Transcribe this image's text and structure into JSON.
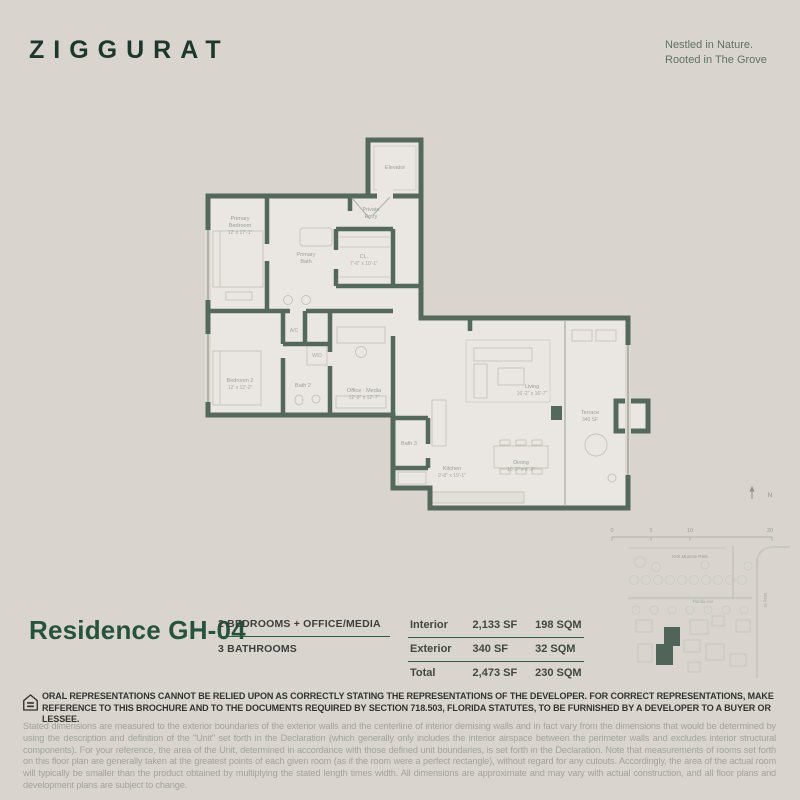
{
  "colors": {
    "background": "#d9d4ce",
    "wall_green": "#55685c",
    "brand_green": "#1c382c",
    "title_green": "#26523e",
    "rule_green": "#2f5c46",
    "floor_fill": "#eae7e2"
  },
  "icons": {
    "equal_housing": "equal-housing-logo",
    "north_arrow": "north-arrow-icon"
  },
  "header": {
    "logo": "ZIGGURAT",
    "tagline_line1": "Nestled in Nature.",
    "tagline_line2": "Rooted in The Grove"
  },
  "floorplan": {
    "elevator": "Elevator",
    "private_entry_1": "Private",
    "private_entry_2": "Entry",
    "primary_bedroom_1": "Primary",
    "primary_bedroom_2": "Bedroom",
    "primary_bedroom_dims": "12' x 17'-1\"",
    "primary_bath_1": "Primary",
    "primary_bath_2": "Bath",
    "closet_name": "CL.",
    "closet_dims": "7'-6\" x 10'-1\"",
    "ac": "A/C",
    "wd": "W/D",
    "bath2": "Bath 2",
    "bedroom2_name": "Bedroom 2",
    "bedroom2_dims": "12' x 12'-2\"",
    "office_name": "Office · Media",
    "office_dims": "12'-9\" x 12'-7\"",
    "bath3": "Bath 3",
    "kitchen_name": "Kitchen",
    "kitchen_dims": "9'-8\" x 19'-1\"",
    "dining_name": "Dining",
    "dining_dims": "10'-2\" x 8'-9\"",
    "living_name": "Living",
    "living_dims": "16'-2\" x 16'-7\"",
    "terrace_name": "Terrace",
    "terrace_dims": "340 SF"
  },
  "sitemap": {
    "north": "N",
    "scale": [
      "0",
      "5",
      "10",
      "20"
    ],
    "park": "Kirk Munroe Park",
    "street_horizontal": "Florida Ave",
    "street_vertical": "Mary St"
  },
  "residence": {
    "title": "Residence GH-04",
    "spec1": "2 BEDROOMS + OFFICE/MEDIA",
    "spec2": "3 BATHROOMS"
  },
  "area_table": {
    "rows": [
      {
        "label": "Interior",
        "sf": "2,133 SF",
        "sqm": "198 SQM"
      },
      {
        "label": "Exterior",
        "sf": "340 SF",
        "sqm": "32 SQM"
      },
      {
        "label": "Total",
        "sf": "2,473 SF",
        "sqm": "230 SQM"
      }
    ]
  },
  "legal": {
    "bold": "ORAL REPRESENTATIONS CANNOT BE RELIED UPON AS CORRECTLY STATING THE REPRESENTATIONS OF THE DEVELOPER.  FOR CORRECT REPRESENTATIONS, MAKE REFERENCE TO THIS BROCHURE AND TO THE DOCUMENTS REQUIRED BY SECTION 718.503, FLORIDA STATUTES, TO BE FURNISHED BY A DEVELOPER TO A BUYER OR LESSEE.",
    "fine": "Stated dimensions are measured to the exterior boundaries of the exterior walls and the centerline of interior demising walls and in fact vary from the dimensions that would be determined by using the description and definition of the \"Unit\" set forth in the Declaration (which generally only includes the interior airspace between the perimeter walls and excludes interior structural components).  For your reference, the area of the Unit, determined in accordance with those defined unit boundaries, is set forth in the Declaration.  Note that measurements of rooms set forth on this floor plan are generally taken at the greatest points of each given room (as if the room were a perfect rectangle), without regard for any cutouts.  Accordingly, the area of the actual room will typically be smaller than the product obtained by multiplying the stated length times width.  All dimensions are approximate and may vary with actual construction, and all floor plans and development plans are subject to change."
  }
}
